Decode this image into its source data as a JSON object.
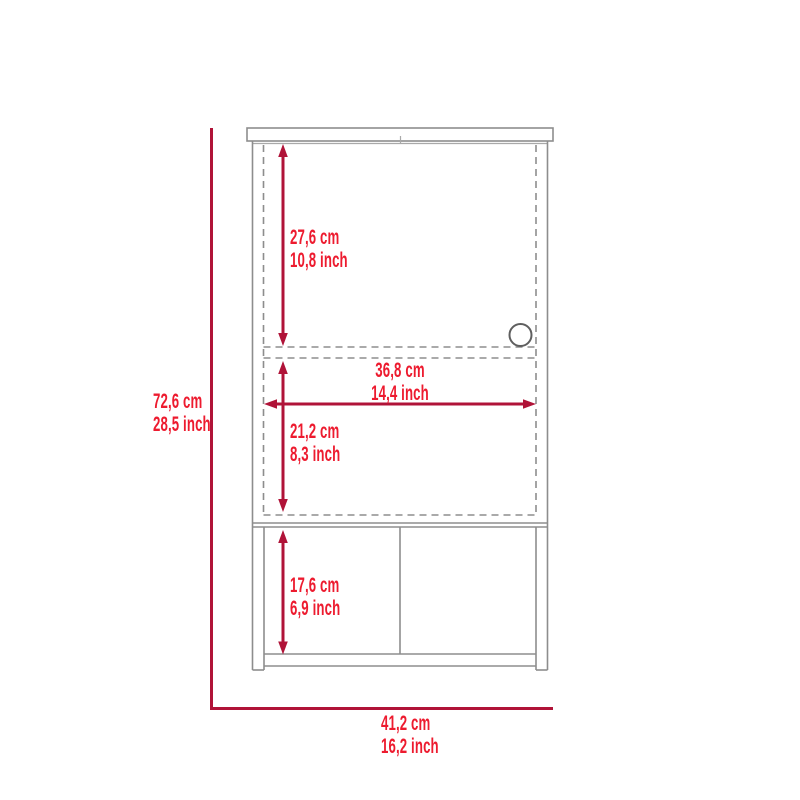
{
  "diagram": {
    "kind": "furniture dimension drawing",
    "view": "cabinet front elevation"
  },
  "colors": {
    "dimension_line": "#b01338",
    "dimension_text": "#ed1b2f",
    "structure_line": "#8d8d8d",
    "structure_line_light": "#a9a9a9",
    "handle_line": "#5f5f5f",
    "background": "#ffffff"
  },
  "dimensions": {
    "total_height": {
      "cm": "72,6 cm",
      "inch": "28,5 inch"
    },
    "top_section_height": {
      "cm": "27,6 cm",
      "inch": "10,8 inch"
    },
    "inner_width": {
      "cm": "36,8 cm",
      "inch": "14,4 inch"
    },
    "middle_section_height": {
      "cm": "21,2 cm",
      "inch": "8,3 inch"
    },
    "bottom_section_height": {
      "cm": "17,6 cm",
      "inch": "6,9 inch"
    },
    "total_width": {
      "cm": "41,2 cm",
      "inch": "16,2 inch"
    }
  }
}
